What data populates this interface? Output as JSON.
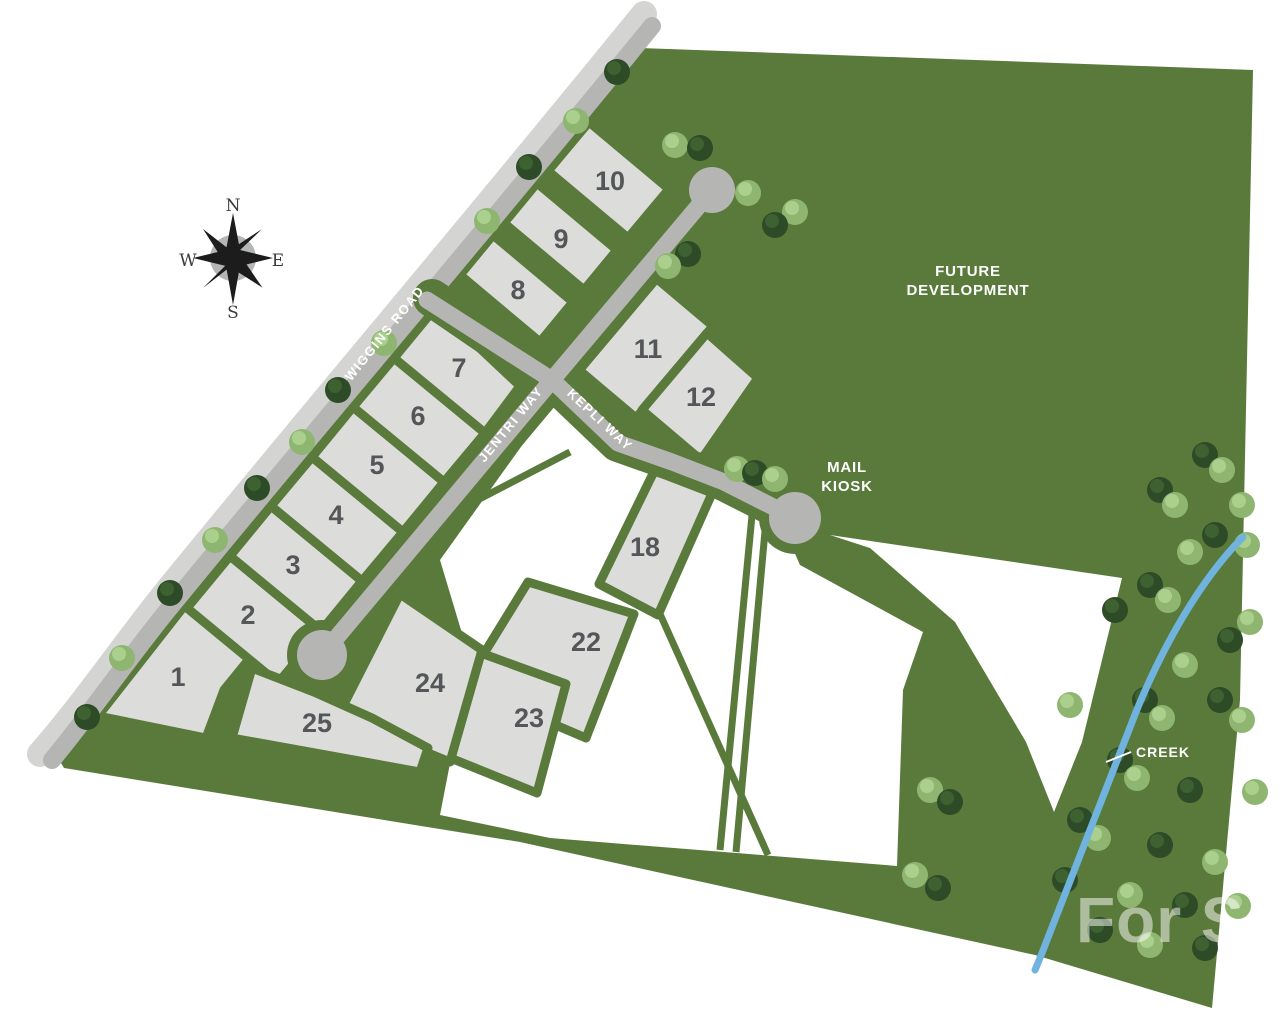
{
  "compass": {
    "north": "N",
    "east": "E",
    "south": "S",
    "west": "W"
  },
  "roads": [
    {
      "name": "WIGGINS ROAD"
    },
    {
      "name": "JENTRI WAY"
    },
    {
      "name": "KEPLI WAY"
    }
  ],
  "areas": {
    "future_development_line1": "FUTURE",
    "future_development_line2": "DEVELOPMENT",
    "mail_kiosk_line1": "MAIL",
    "mail_kiosk_line2": "KIOSK",
    "creek": "CREEK"
  },
  "watermark": "For Sale",
  "lots": {
    "numbers": [
      "1",
      "2",
      "3",
      "4",
      "5",
      "6",
      "7",
      "8",
      "9",
      "10",
      "11",
      "12",
      "18",
      "22",
      "23",
      "24",
      "25"
    ]
  },
  "colors": {
    "site_green": "#5a7a3c",
    "lot_fill": "#dcddda",
    "road_fill": "#b5b6b4",
    "road_shoulder": "#d4d5d3",
    "parcel_white": "#ffffff",
    "creek_blue": "#6fb3de",
    "number_text": "#55565a",
    "map_text": "#ffffff",
    "tree_dark": "#2d4b27",
    "tree_dark_hi": "#3d6130",
    "tree_light": "#8fb671",
    "tree_light_hi": "#abd08d",
    "compass_dark": "#1c1c1c",
    "compass_gray": "#9b9c9e"
  }
}
